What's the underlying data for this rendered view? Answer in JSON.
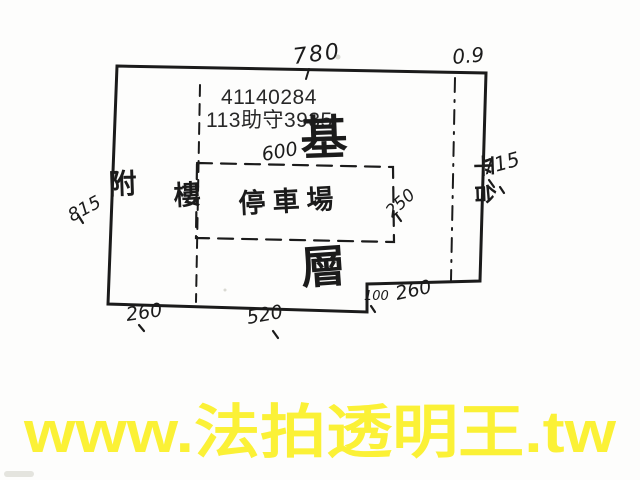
{
  "colors": {
    "paper": "#fdfdfc",
    "ink": "#1b1b1b",
    "printed_text": "#282828",
    "watermark_yellow": "#FBF136"
  },
  "stamp": {
    "line1": "41140284",
    "line2": "113助守3935"
  },
  "plan": {
    "big_label_top": "基",
    "big_label_bottom": "層",
    "parking_label": "停車場",
    "platform_label": "平台",
    "floor_label": "樓",
    "annex_label": "附",
    "dims": {
      "top": "780",
      "top_right": "0.9",
      "inner_top": "600",
      "left": "815",
      "right": "715",
      "inner_right": "250",
      "bottom_left": "260",
      "bottom_center": "520",
      "notch_height": "100",
      "notch_width": "260"
    }
  },
  "watermark": {
    "text": "www.法拍透明王.tw"
  }
}
